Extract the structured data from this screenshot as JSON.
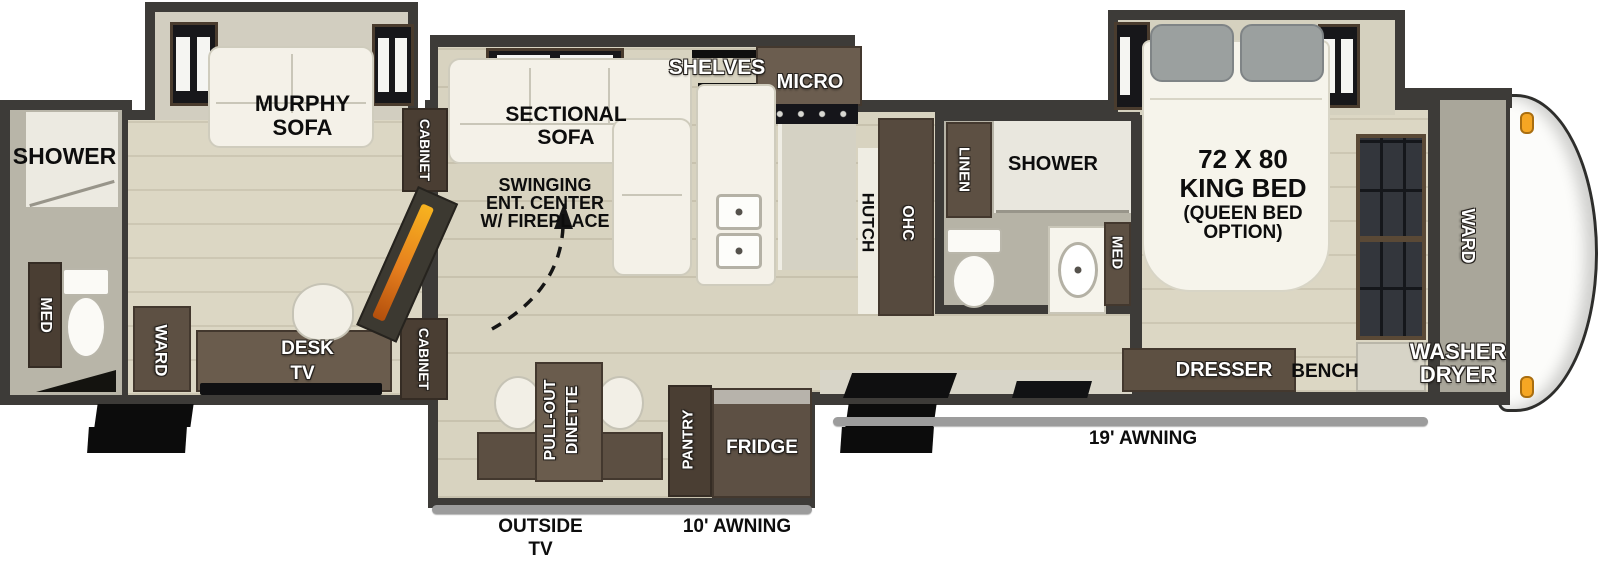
{
  "title": "Fifth wheel RV floor plan",
  "labels": {
    "rear_bath": {
      "shower": "SHOWER",
      "med": "MED"
    },
    "office": {
      "murphy_1": "MURPHY",
      "murphy_2": "SOFA",
      "ward": "WARD",
      "desk": "DESK",
      "tv": "TV"
    },
    "cabinets": {
      "top": "CABINET",
      "bottom": "CABINET"
    },
    "living": {
      "sectional_1": "SECTIONAL",
      "sectional_2": "SOFA",
      "swing_1": "SWINGING",
      "swing_2": "ENT. CENTER",
      "swing_3": "W/ FIREPLACE",
      "shelves": "SHELVES",
      "micro": "MICRO"
    },
    "kitchen": {
      "hutch": "HUTCH",
      "ohc": "OHC"
    },
    "mid_bath": {
      "linen": "LINEN",
      "shower": "SHOWER",
      "med": "MED"
    },
    "bedroom": {
      "bed_1": "72 X 80",
      "bed_2": "KING BED",
      "bed_3": "(QUEEN BED",
      "bed_4": "OPTION)",
      "dresser": "DRESSER",
      "bench": "BENCH"
    },
    "front": {
      "ward": "WARD",
      "washer_1": "WASHER",
      "washer_2": "DRYER"
    },
    "slide": {
      "pullout_1": "PULL-OUT",
      "pullout_2": "DINETTE",
      "pantry": "PANTRY",
      "fridge": "FRIDGE"
    },
    "exterior": {
      "awning_19": "19' AWNING",
      "awning_10": "10' AWNING",
      "outside_tv_1": "OUTSIDE",
      "outside_tv_2": "TV"
    }
  },
  "colors": {
    "wall": "#3d3b38",
    "floor_tan": "#d8d3c0",
    "bath_floor": "#b6b3a6",
    "cabinet_brown": "#5d5043",
    "white_furniture": "#f4f1e8",
    "awning_gray": "#9c9c9c",
    "marker_light_orange": "#f5a623",
    "fireplace_orange": "#e67f1e",
    "step_black": "#0c0c0c"
  }
}
